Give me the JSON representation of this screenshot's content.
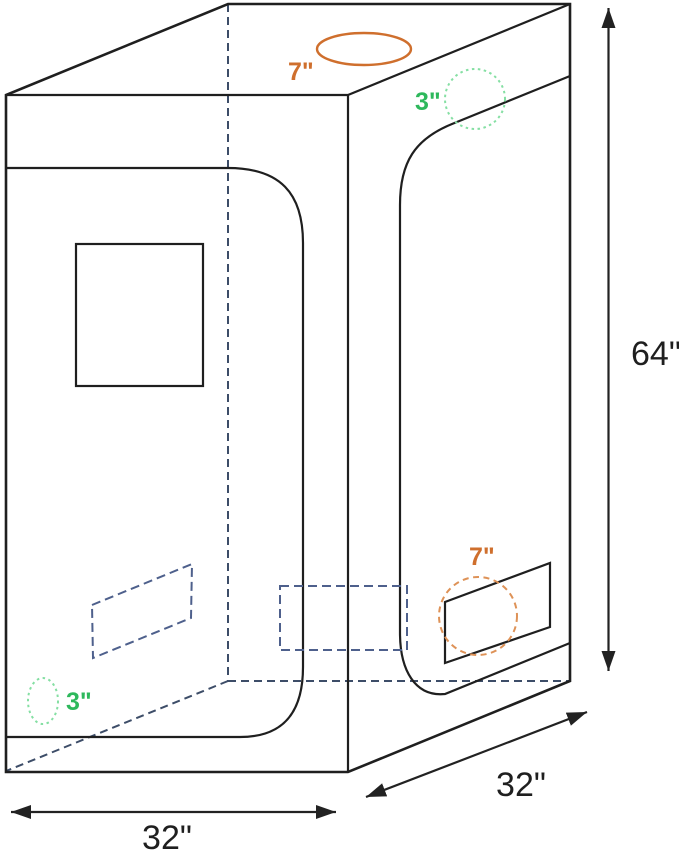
{
  "figure": {
    "description": "Grow tent product dimension line drawing, 3D view with doors, window and vent openings",
    "height_label": "64\"",
    "width_label": "32\"",
    "depth_label": "32\"",
    "top_duct_label": "7\"",
    "top_vent_label": "3\"",
    "side_duct_label": "7\"",
    "side_vent_label": "3\"",
    "colors": {
      "outline_black": "#1f1f1f",
      "hidden_edge_blue": "#3d4d68",
      "vent_rect_blue": "#4e608c",
      "duct_orange": "#cf6f2d",
      "duct_orange_dashed": "#de9257",
      "vent_green_label": "#2eb85c",
      "vent_green_dotted": "#85dfa3"
    }
  }
}
